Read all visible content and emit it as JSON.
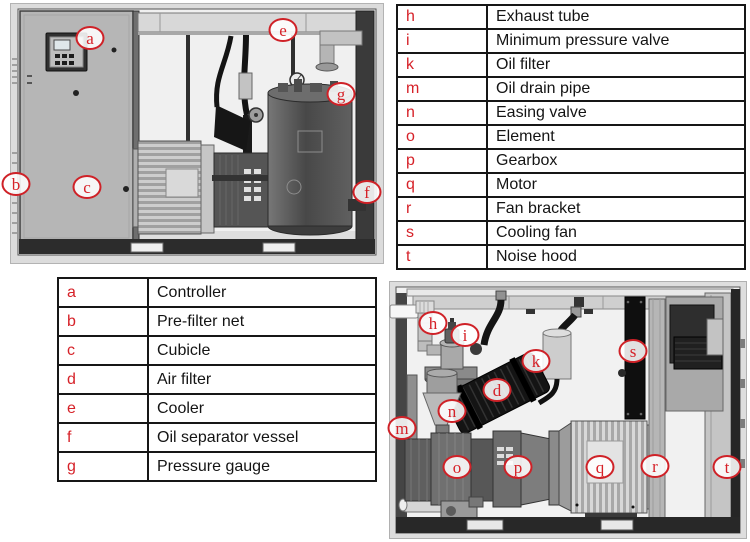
{
  "palette": {
    "callout_red": "#d62128",
    "table_border": "#161616",
    "machine_dark": "#2c2c2c",
    "machine_gray": "#b6b6b6",
    "background": "#ffffff"
  },
  "legend_right": {
    "rows": [
      {
        "key": "h",
        "label": "Exhaust tube"
      },
      {
        "key": "i",
        "label": "Minimum pressure valve"
      },
      {
        "key": "k",
        "label": "Oil filter"
      },
      {
        "key": "m",
        "label": "Oil drain pipe"
      },
      {
        "key": "n",
        "label": "Easing valve"
      },
      {
        "key": "o",
        "label": "Element"
      },
      {
        "key": "p",
        "label": "Gearbox"
      },
      {
        "key": "q",
        "label": "Motor"
      },
      {
        "key": "r",
        "label": "Fan bracket"
      },
      {
        "key": "s",
        "label": "Cooling fan"
      },
      {
        "key": "t",
        "label": "Noise hood"
      }
    ]
  },
  "legend_left": {
    "rows": [
      {
        "key": "a",
        "label": "Controller"
      },
      {
        "key": "b",
        "label": "Pre-filter net"
      },
      {
        "key": "c",
        "label": "Cubicle"
      },
      {
        "key": "d",
        "label": "Air filter"
      },
      {
        "key": "e",
        "label": "Cooler"
      },
      {
        "key": "f",
        "label": "Oil separator vessel"
      },
      {
        "key": "g",
        "label": "Pressure gauge"
      }
    ]
  },
  "diagram_front": {
    "callouts": [
      "a",
      "e",
      "g",
      "b",
      "c",
      "f"
    ]
  },
  "diagram_internal": {
    "callouts": [
      "h",
      "i",
      "k",
      "d",
      "n",
      "m",
      "o",
      "p",
      "q",
      "r",
      "s",
      "t"
    ]
  }
}
